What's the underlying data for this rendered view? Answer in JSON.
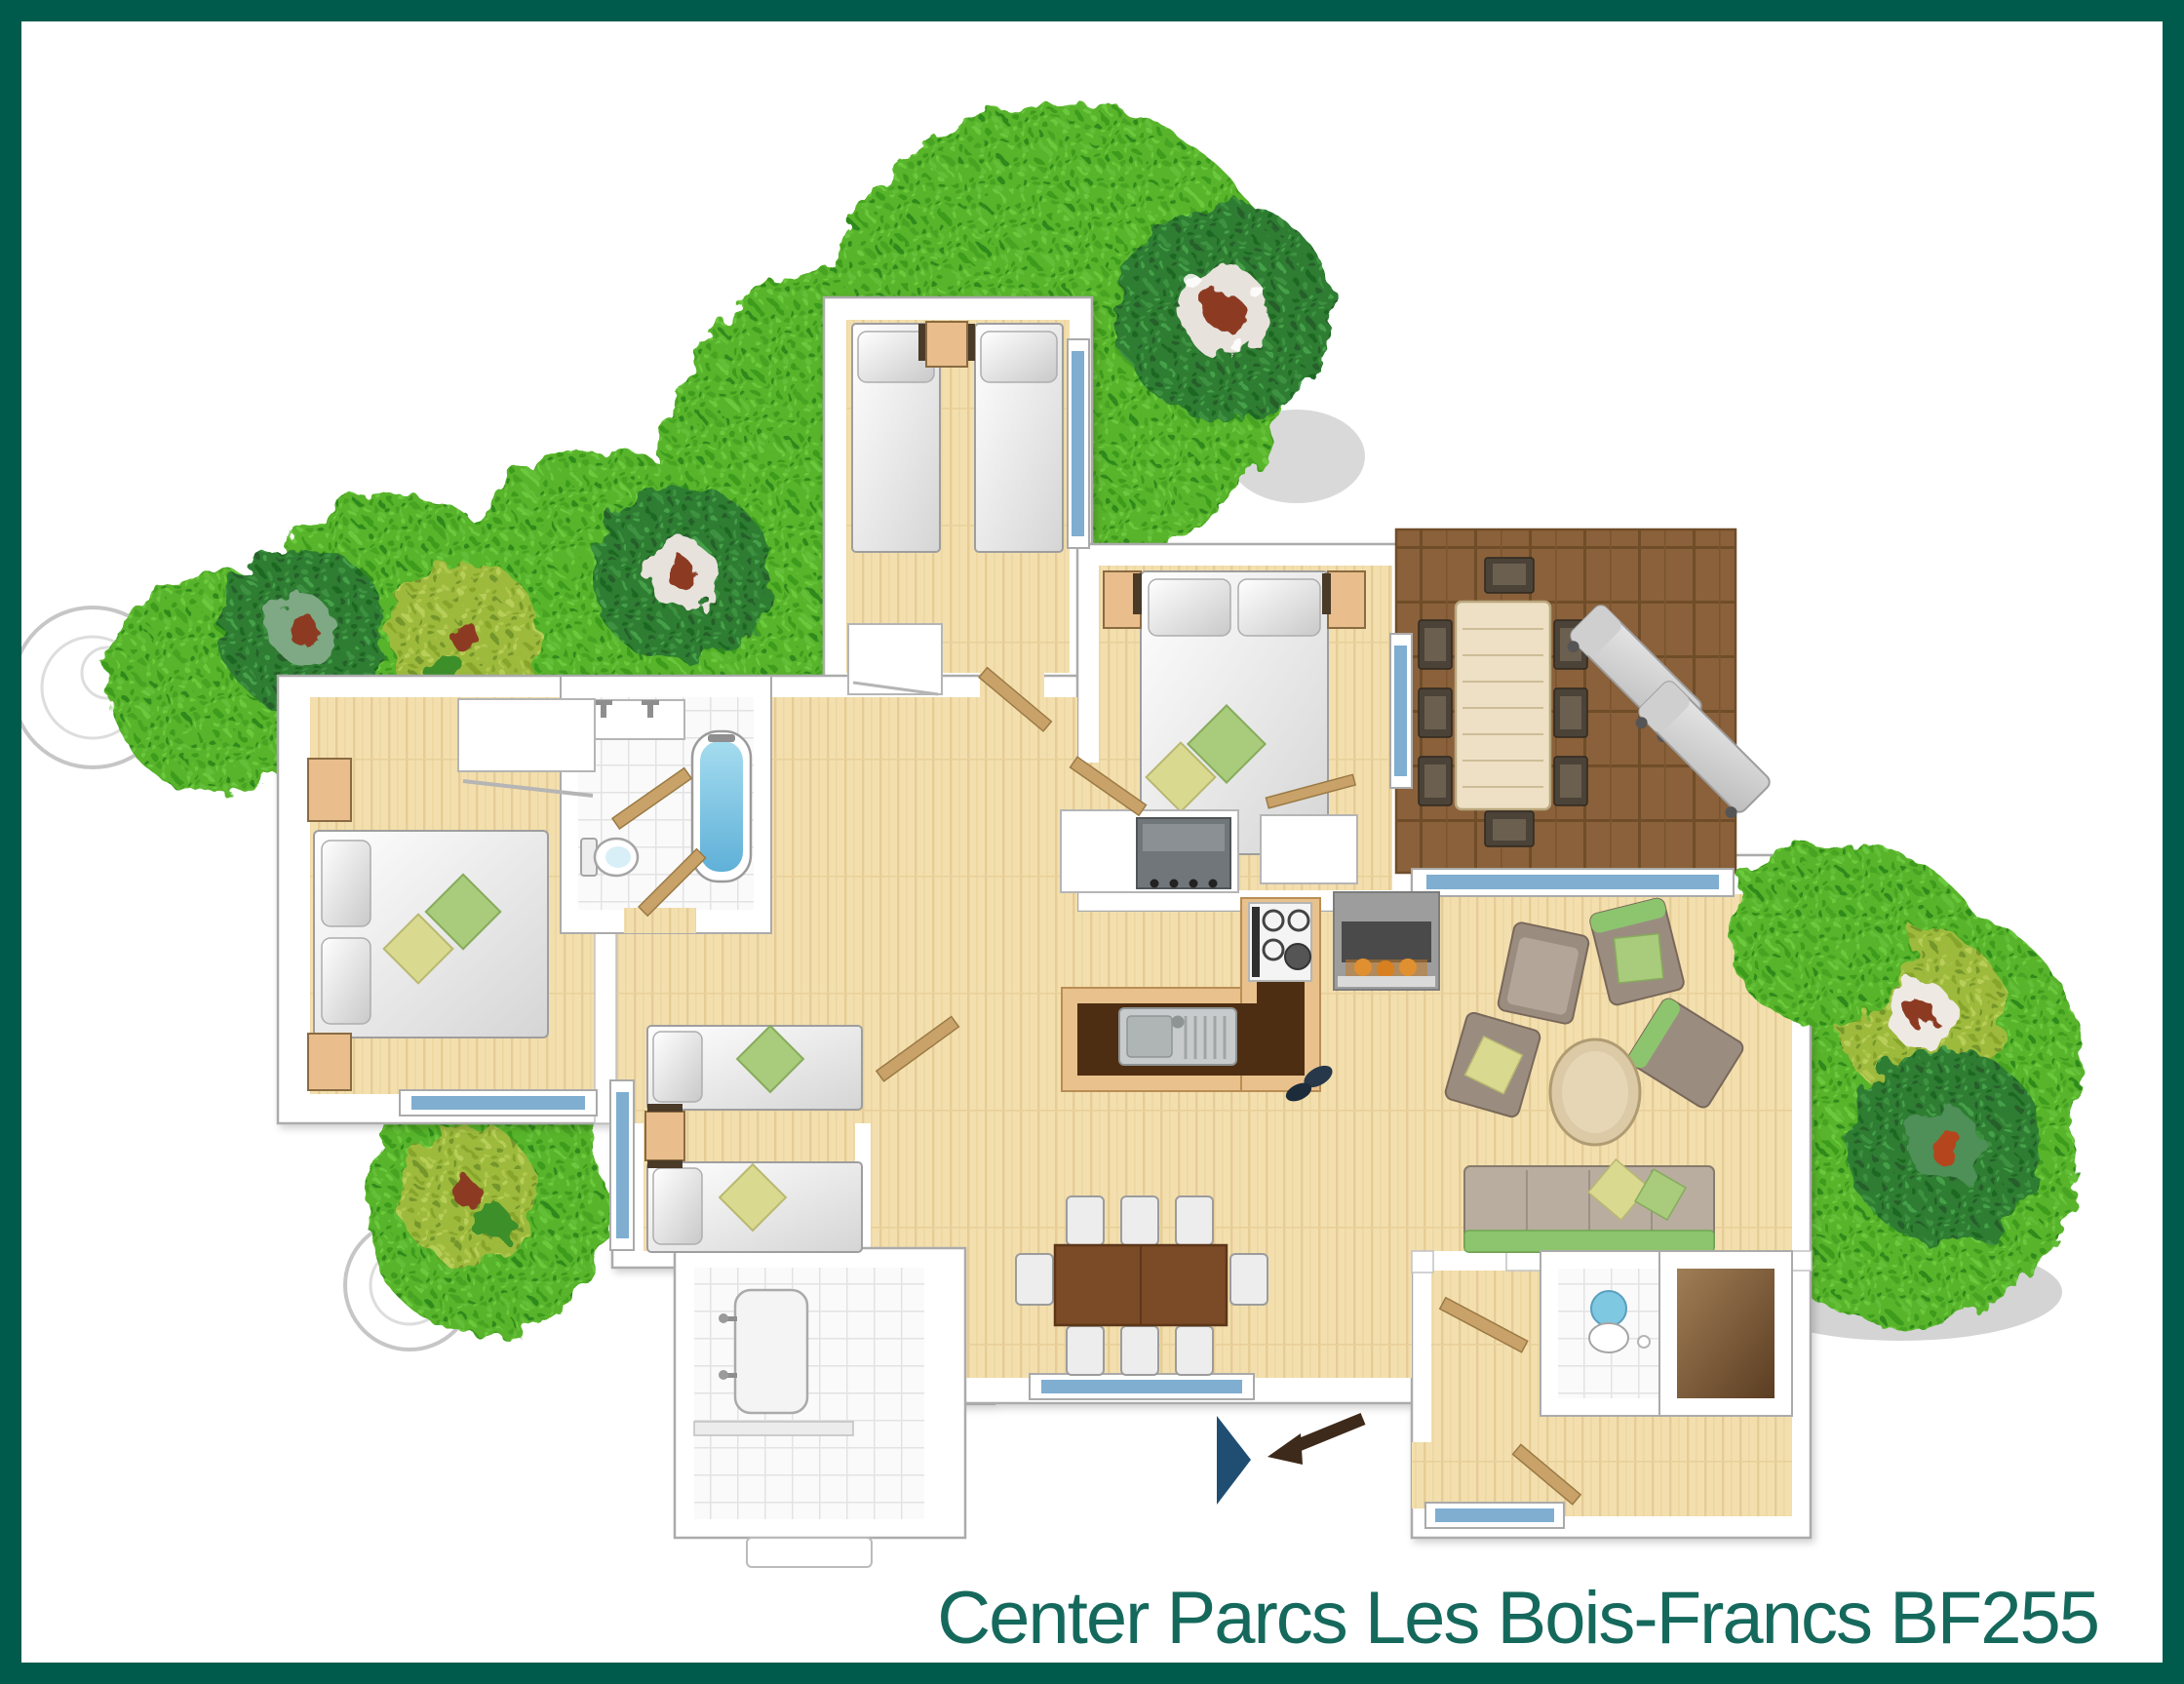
{
  "title": "Center Parcs Les Bois-Francs BF255",
  "palette": {
    "frame": "#005B4D",
    "title_text": "#15695C",
    "wood": "#F3DFAE",
    "deck": "#8A613A",
    "green_base": "#58B42C",
    "green_dark": "#2E7D32",
    "green_yellow": "#9DBA3C",
    "tree_core_red": "#8C3B24",
    "tile": "#FAFAFA",
    "wall": "#FFFFFF",
    "wall_line": "#ABABAB",
    "window_glass": "#7FAED1",
    "counter_dark": "#4D2E12",
    "counter_tan": "#E9C18D",
    "steel": "#C7CBCB",
    "appliance": "#70767A",
    "fire_logs": "#E09030",
    "bath_water": "#7EC8E2",
    "sofa_green": "#8CC56E",
    "cushion_green": "#A8CB7C",
    "cushion_yellow": "#D9D98F",
    "nightstand": "#E9BE8C",
    "furniture_gray": "#9A8D80",
    "lounger": "#D6D6D6",
    "entrance_navy": "#1F4E72",
    "door_leaf": "#C9A269",
    "arrow_brown": "#3E2A1A",
    "ghost_outline": "#C6C6C6"
  }
}
